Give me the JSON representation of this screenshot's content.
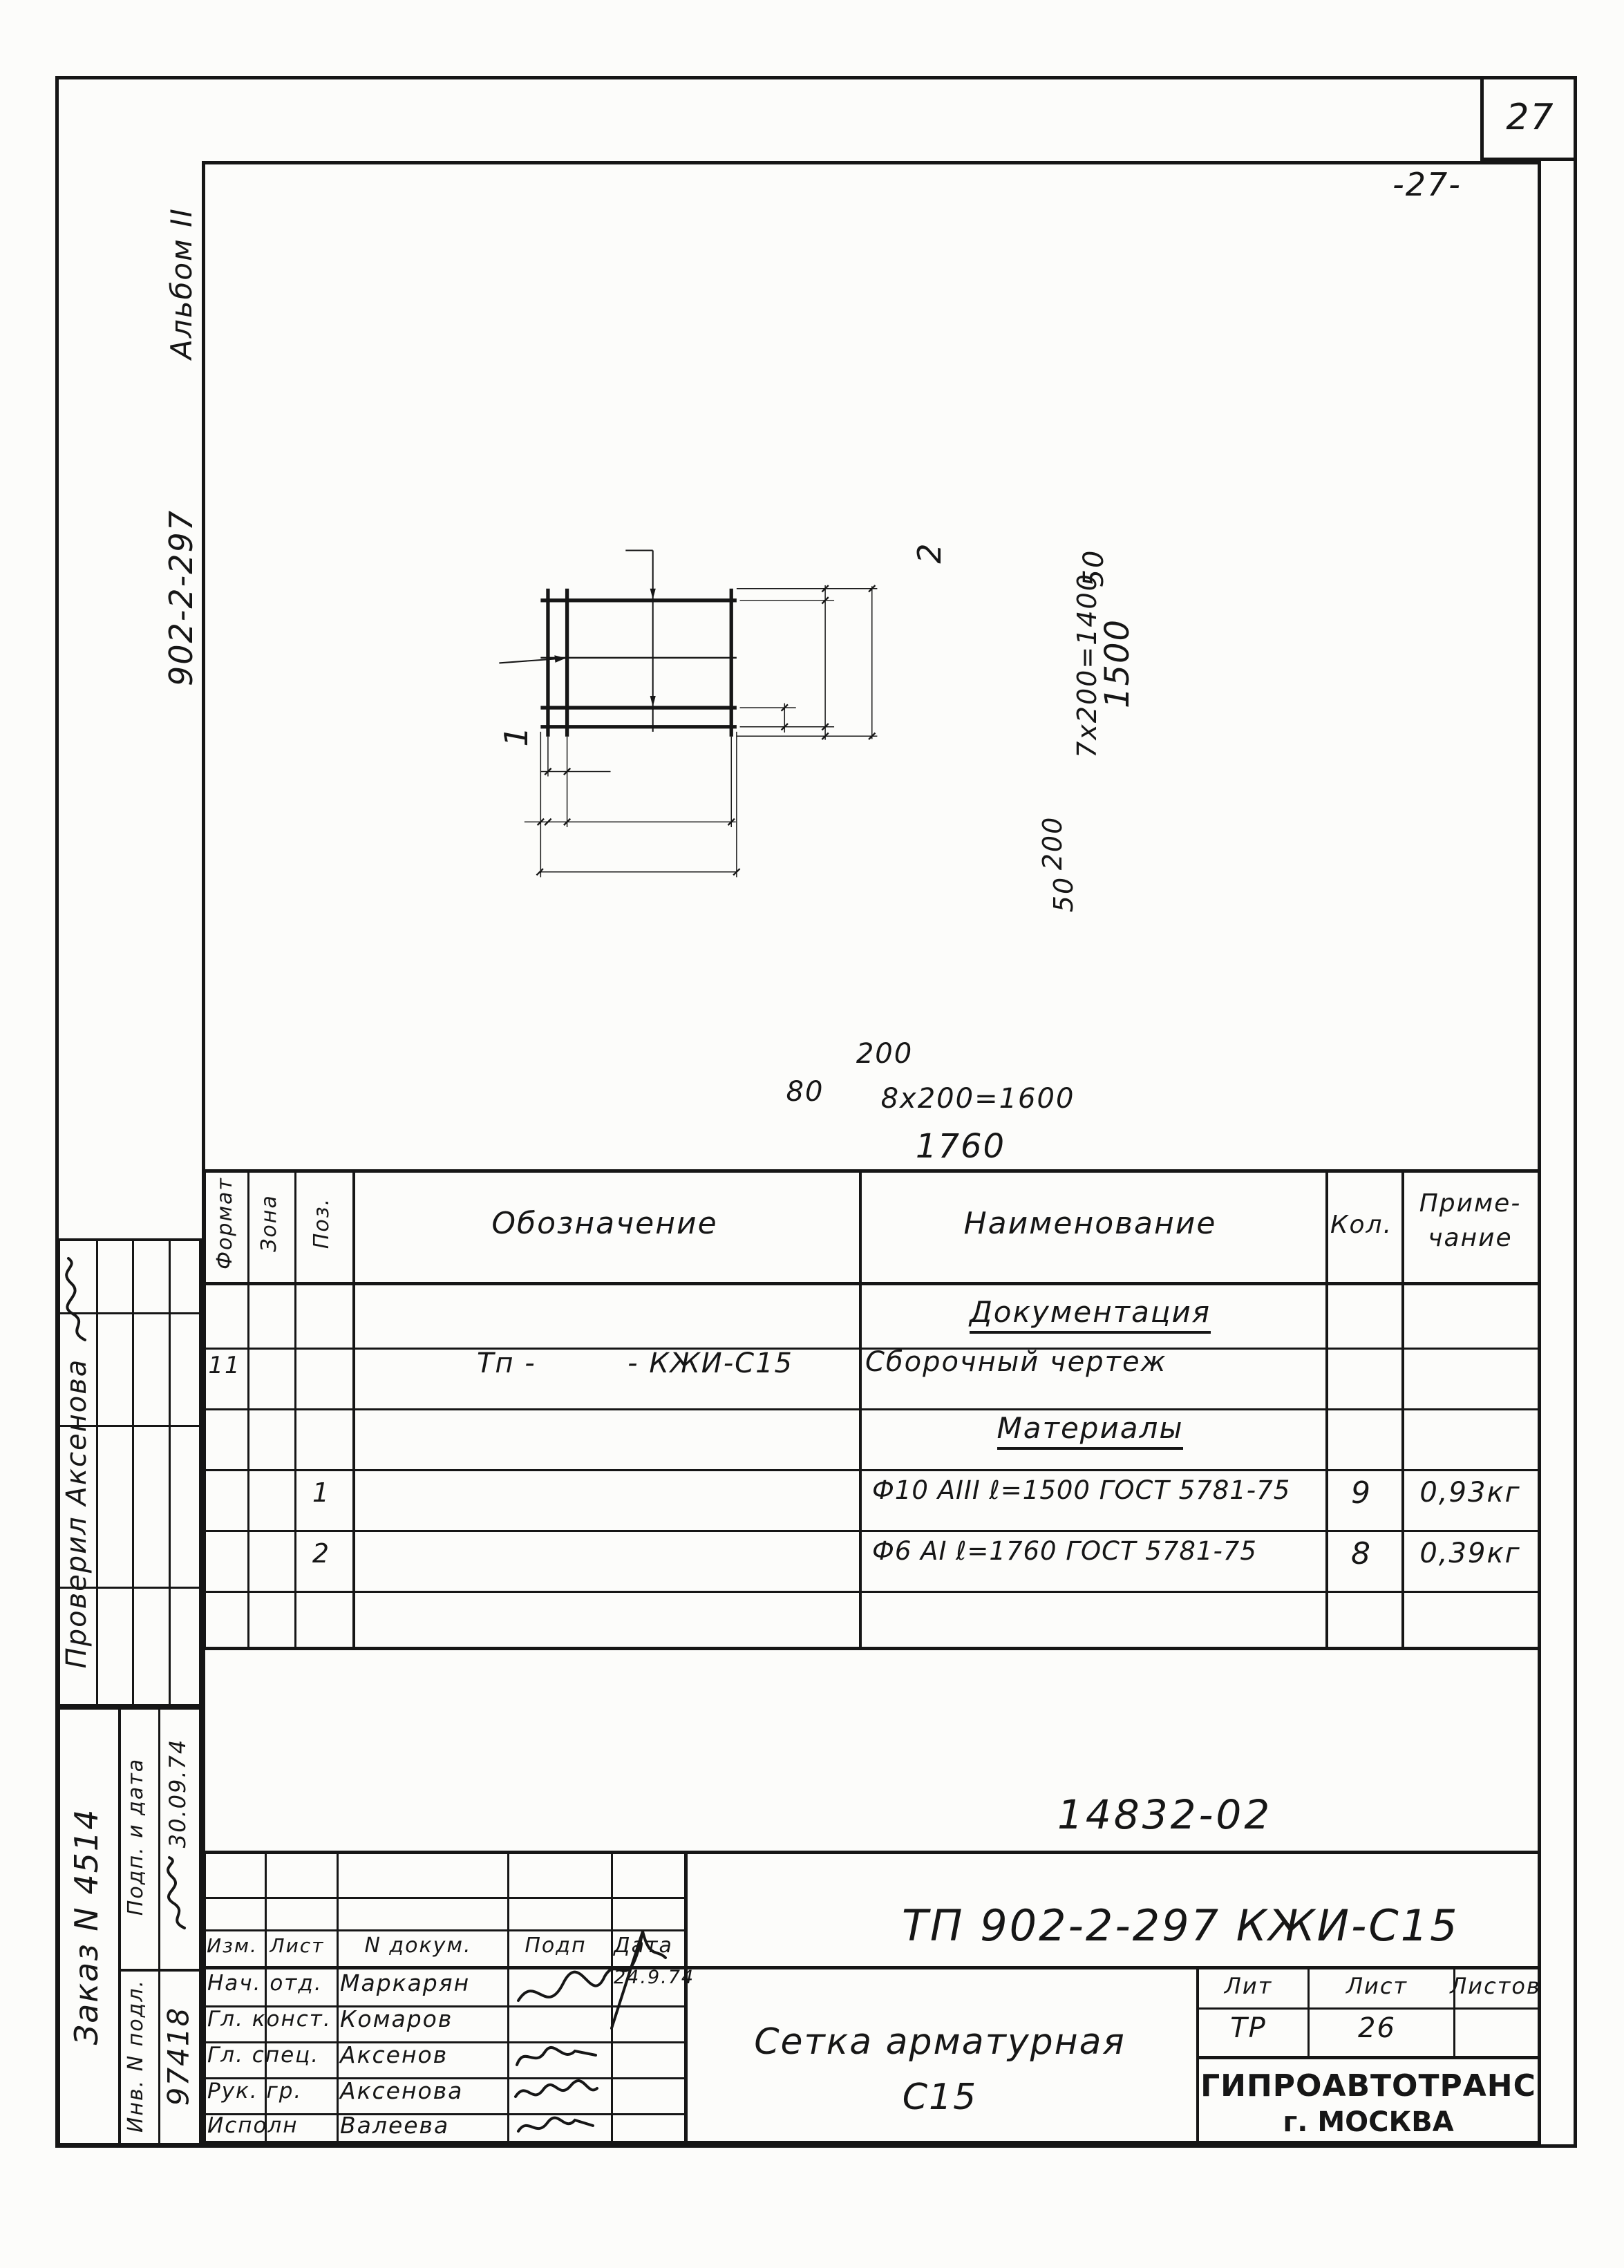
{
  "page": {
    "sheet_number": "27",
    "sheet_number_center": "-27-",
    "doc_number": "14832-02"
  },
  "margin": {
    "album": "Альбом II",
    "project_code": "902-2-297",
    "checked": "Проверил Аксенова",
    "order": "Заказ N 4514",
    "sign_date_label": "Подп. и дата",
    "sign_date_value": "30.09.74",
    "inv_label": "Инв. N подл.",
    "inv_value": "97418"
  },
  "drawing": {
    "callout_1": "1",
    "callout_2": "2",
    "dim_spacing_first": "200",
    "dim_edge_left": "80",
    "dim_row_bottom": "8х200=1600",
    "dim_width_total": "1760",
    "dim_edge_top": "50",
    "dim_col_right": "7х200=1400",
    "dim_height_total": "1500",
    "dim_spacing_bottom": "200",
    "dim_edge_bottom": "50"
  },
  "bom": {
    "headers": {
      "format": "Формат",
      "zone": "Зона",
      "pos": "Поз.",
      "designation": "Обозначение",
      "name": "Наименование",
      "qty": "Кол.",
      "note1": "Приме-",
      "note2": "чание"
    },
    "rows": {
      "0": {
        "name": "Документация"
      },
      "1": {
        "format": "11",
        "designation": "Тп -         - КЖИ-С15",
        "name": "Сборочный чертеж"
      },
      "2": {
        "name": "Материалы"
      },
      "3": {
        "pos": "1",
        "name": "Ф10 АIII ℓ=1500 ГОСТ 5781-75",
        "qty": "9",
        "note": "0,93кг"
      },
      "4": {
        "pos": "2",
        "name": "Ф6 АI ℓ=1760 ГОСТ 5781-75",
        "qty": "8",
        "note": "0,39кг"
      }
    }
  },
  "titleblock": {
    "designation": "ТП 902-2-297 КЖИ-С15",
    "title_line1": "Сетка арматурная",
    "title_line2": "С15",
    "rev_headers": {
      "izm": "Изм.",
      "list": "Лист",
      "doc": "N докум.",
      "sign": "Подп",
      "date": "Дата"
    },
    "roles": {
      "0": {
        "role": "Нач. отд.",
        "name": "Маркарян",
        "date": "24.9.74"
      },
      "1": {
        "role": "Гл. конст.",
        "name": "Комаров",
        "date": ""
      },
      "2": {
        "role": "Гл. спец.",
        "name": "Аксенов",
        "date": ""
      },
      "3": {
        "role": "Рук. гр.",
        "name": "Аксенова",
        "date": ""
      },
      "4": {
        "role": "Исполн",
        "name": "Валеева",
        "date": ""
      }
    },
    "lit_headers": {
      "lit": "Лит",
      "list": "Лист",
      "listov": "Листов"
    },
    "lit": "ТР",
    "sheet": "26",
    "sheets": "",
    "org": "ГИПРОАВТОТРАНС",
    "city": "г. МОСКВА"
  }
}
